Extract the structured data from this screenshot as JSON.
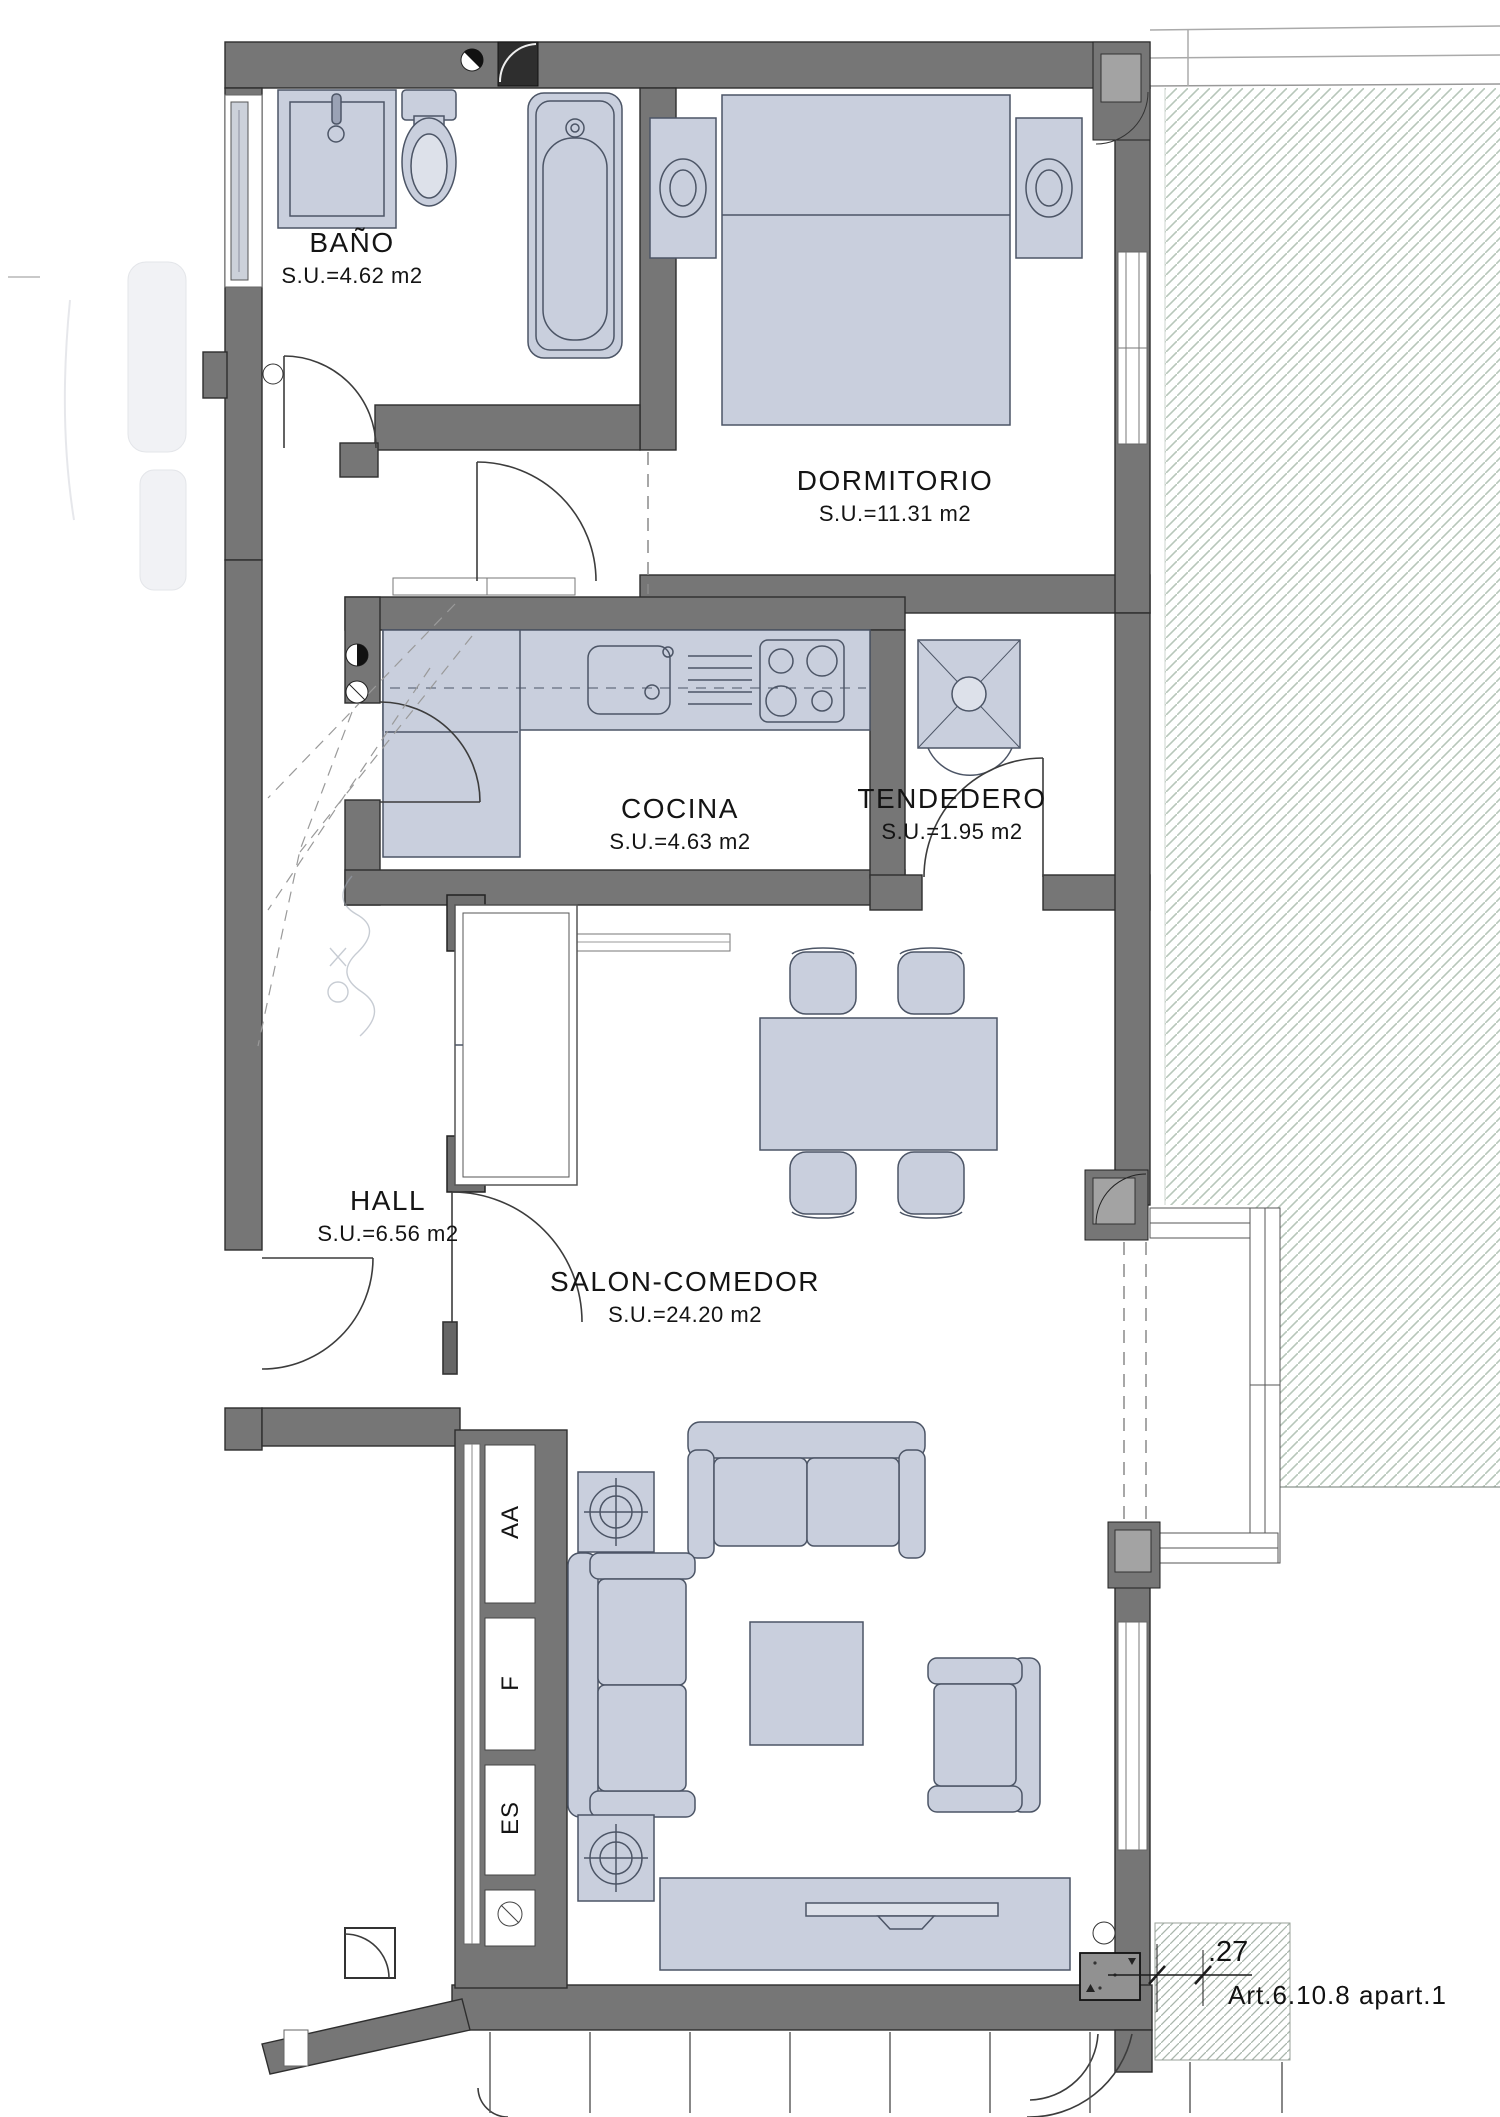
{
  "plan": {
    "rooms": [
      {
        "name": "BAÑO",
        "area": "S.U.=4.62 m2"
      },
      {
        "name": "DORMITORIO",
        "area": "S.U.=11.31 m2"
      },
      {
        "name": "COCINA",
        "area": "S.U.=4.63 m2"
      },
      {
        "name": "TENDEDERO",
        "area": "S.U.=1.95 m2"
      },
      {
        "name": "HALL",
        "area": "S.U.=6.56 m2"
      },
      {
        "name": "SALON-COMEDOR",
        "area": "S.U.=24.20 m2"
      }
    ],
    "shaft_labels": [
      {
        "label": "AA"
      },
      {
        "label": "F"
      },
      {
        "label": "ES"
      }
    ],
    "annotations": {
      "dimension_value": ".27",
      "regulation_ref": "Art.6.10.8  apart.1"
    },
    "colors": {
      "wall": "#767676",
      "furniture_fill": "#c9cfdd",
      "furniture_stroke": "#4c5566",
      "hatch": "#b7c6ba",
      "text": "#141414"
    }
  }
}
